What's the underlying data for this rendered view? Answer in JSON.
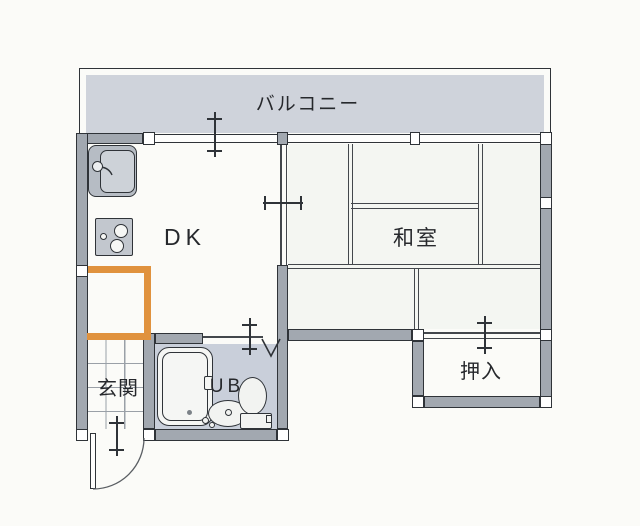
{
  "labels": {
    "balcony": "バルコニー",
    "dining_kitchen": "DK",
    "japanese_room": "和室",
    "entrance": "玄関",
    "unit_bath": "UB",
    "closet": "押入"
  },
  "colors": {
    "paper": "#fbfbf8",
    "wall_fill": "#a2a8b0",
    "wall_line": "#2f3338",
    "balcony_fill": "#cfd3db",
    "bath_fill": "#c9cfda",
    "accent_orange": "#e0923e",
    "tile_line": "#9aa0a7",
    "text": "#26282c"
  }
}
